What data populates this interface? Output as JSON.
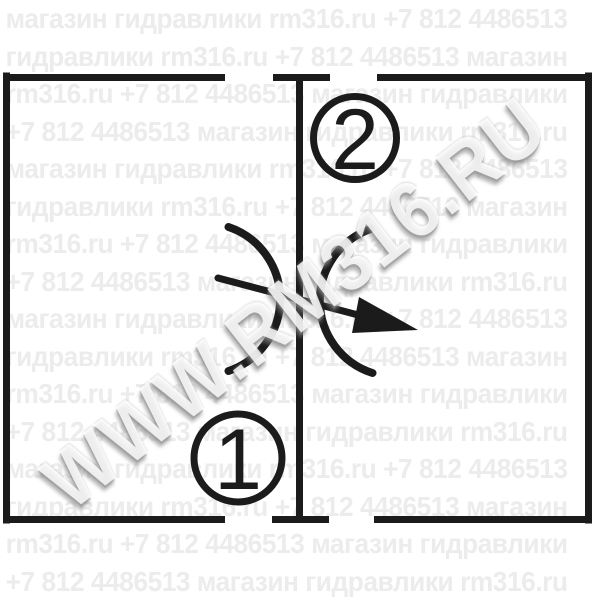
{
  "watermark": {
    "diagonal": "WWW.RM316.RU",
    "phrases": [
      "магазин",
      "гидравлики",
      "rm316.ru",
      "+7 812 4486513"
    ],
    "rows": [
      "магазин гидравлики rm316.ru +7 812 4486513",
      "гидравлики rm316.ru +7 812 4486513 магазин",
      "rm316.ru +7 812 4486513 магазин гидравлики",
      "+7 812 4486513 магазин гидравлики rm316.ru",
      "магазин гидравлики rm316.ru +7 812 4486513",
      "гидравлики rm316.ru +7 812 4486513 магазин",
      "rm316.ru +7 812 4486513 магазин гидравлики",
      "+7 812 4486513 магазин гидравлики rm316.ru",
      "магазин гидравлики rm316.ru +7 812 4486513",
      "гидравлики rm316.ru +7 812 4486513 магазин",
      "rm316.ru +7 812 4486513 магазин гидравлики",
      "+7 812 4486513 магазин гидравлики rm316.ru",
      "магазин гидравлики rm316.ru +7 812 4486513",
      "гидравлики rm316.ru +7 812 4486513 магазин",
      "rm316.ru +7 812 4486513 магазин гидравлики",
      "+7 812 4486513 магазин гидравлики rm316.ru"
    ]
  },
  "symbol": {
    "description": "adjustable throttle valve schematic",
    "port_top_label": "2",
    "port_bottom_label": "1"
  },
  "colors": {
    "line": "#1b1b1b",
    "watermark_text": "#ececec",
    "background": "#ffffff"
  }
}
